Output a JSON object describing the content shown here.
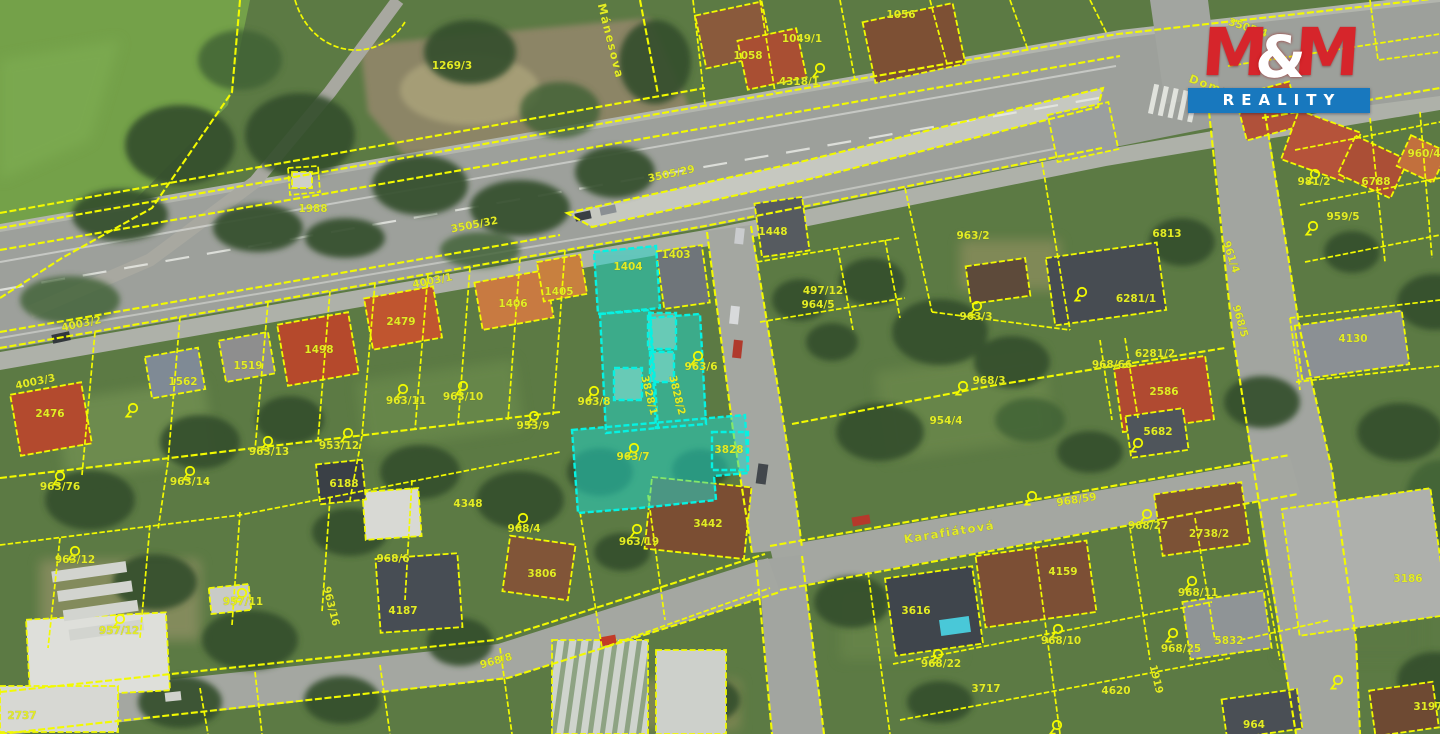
{
  "logo": {
    "m1": "M",
    "amp": "&",
    "m2": "M",
    "reality": "REALITY"
  },
  "colors": {
    "cadastral_line": "#f2fa00",
    "label": "#e3ec25",
    "highlight_fill": "#20d9cc",
    "highlight_stroke": "#06f2e2",
    "logo_red": "#d6252b",
    "logo_blue": "#1878be"
  },
  "map": {
    "street_labels": [
      {
        "t": "Domažlická",
        "x": 1230,
        "y": 97,
        "r": 20,
        "k": "street"
      },
      {
        "t": "Karafiátová",
        "x": 950,
        "y": 536,
        "r": -9,
        "k": "street"
      },
      {
        "t": "Mánesova",
        "x": 607,
        "y": 42,
        "r": 76,
        "k": "street"
      }
    ],
    "labels": [
      {
        "t": "3505/4",
        "x": 1247,
        "y": 31,
        "r": 18
      },
      {
        "t": "3505/29",
        "x": 672,
        "y": 177,
        "r": -12
      },
      {
        "t": "3505/32",
        "x": 475,
        "y": 228,
        "r": -11
      },
      {
        "t": "4003/1",
        "x": 433,
        "y": 284,
        "r": -11
      },
      {
        "t": "4003/2",
        "x": 82,
        "y": 327,
        "r": -12
      },
      {
        "t": "4003/3",
        "x": 36,
        "y": 385,
        "r": -12
      },
      {
        "t": "1269/3",
        "x": 452,
        "y": 69
      },
      {
        "t": "1988",
        "x": 313,
        "y": 212
      },
      {
        "t": "1058",
        "x": 748,
        "y": 59
      },
      {
        "t": "1049/1",
        "x": 802,
        "y": 42
      },
      {
        "t": "1056",
        "x": 901,
        "y": 18
      },
      {
        "t": "4318/1",
        "x": 799,
        "y": 85
      },
      {
        "t": "1403",
        "x": 676,
        "y": 258
      },
      {
        "t": "1404",
        "x": 628,
        "y": 270
      },
      {
        "t": "1448",
        "x": 773,
        "y": 235
      },
      {
        "t": "497/12",
        "x": 823,
        "y": 294
      },
      {
        "t": "964/5",
        "x": 818,
        "y": 308
      },
      {
        "t": "963/2",
        "x": 973,
        "y": 239
      },
      {
        "t": "6813",
        "x": 1167,
        "y": 237
      },
      {
        "t": "963/3",
        "x": 976,
        "y": 320
      },
      {
        "t": "968/3",
        "x": 989,
        "y": 384
      },
      {
        "t": "6281/1",
        "x": 1136,
        "y": 302
      },
      {
        "t": "6281/2",
        "x": 1155,
        "y": 357
      },
      {
        "t": "968/66",
        "x": 1112,
        "y": 368
      },
      {
        "t": "2586",
        "x": 1164,
        "y": 395
      },
      {
        "t": "5682",
        "x": 1158,
        "y": 435
      },
      {
        "t": "954/4",
        "x": 946,
        "y": 424
      },
      {
        "t": "1498",
        "x": 319,
        "y": 353
      },
      {
        "t": "2479",
        "x": 401,
        "y": 325
      },
      {
        "t": "2476",
        "x": 50,
        "y": 417
      },
      {
        "t": "1406",
        "x": 513,
        "y": 307
      },
      {
        "t": "1405",
        "x": 559,
        "y": 295
      },
      {
        "t": "1519",
        "x": 248,
        "y": 369
      },
      {
        "t": "1562",
        "x": 183,
        "y": 385
      },
      {
        "t": "963/8",
        "x": 594,
        "y": 405
      },
      {
        "t": "963/6",
        "x": 701,
        "y": 370
      },
      {
        "t": "963/7",
        "x": 633,
        "y": 460
      },
      {
        "t": "3828",
        "x": 729,
        "y": 453
      },
      {
        "t": "3828/1",
        "x": 646,
        "y": 396,
        "r": 76,
        "s": 9
      },
      {
        "t": "3828/2",
        "x": 674,
        "y": 396,
        "r": 76,
        "s": 9
      },
      {
        "t": "963/11",
        "x": 406,
        "y": 404
      },
      {
        "t": "963/10",
        "x": 463,
        "y": 400
      },
      {
        "t": "953/9",
        "x": 533,
        "y": 429
      },
      {
        "t": "953/12",
        "x": 339,
        "y": 449
      },
      {
        "t": "6188",
        "x": 344,
        "y": 487
      },
      {
        "t": "963/13",
        "x": 269,
        "y": 455
      },
      {
        "t": "963/76",
        "x": 60,
        "y": 490
      },
      {
        "t": "963/14",
        "x": 190,
        "y": 485
      },
      {
        "t": "963/12",
        "x": 75,
        "y": 563
      },
      {
        "t": "957/11",
        "x": 243,
        "y": 605
      },
      {
        "t": "957/12",
        "x": 119,
        "y": 634
      },
      {
        "t": "963/16",
        "x": 328,
        "y": 607,
        "r": 76,
        "s": 9
      },
      {
        "t": "2737",
        "x": 22,
        "y": 719
      },
      {
        "t": "968/6",
        "x": 393,
        "y": 562
      },
      {
        "t": "968/4",
        "x": 524,
        "y": 532
      },
      {
        "t": "4348",
        "x": 468,
        "y": 507
      },
      {
        "t": "3806",
        "x": 542,
        "y": 577
      },
      {
        "t": "4187",
        "x": 403,
        "y": 614
      },
      {
        "t": "968/8",
        "x": 497,
        "y": 664,
        "r": -16
      },
      {
        "t": "963/19",
        "x": 639,
        "y": 545
      },
      {
        "t": "3442",
        "x": 708,
        "y": 527
      },
      {
        "t": "4159",
        "x": 1063,
        "y": 575
      },
      {
        "t": "968/10",
        "x": 1061,
        "y": 644
      },
      {
        "t": "3616",
        "x": 916,
        "y": 614
      },
      {
        "t": "968/22",
        "x": 941,
        "y": 667
      },
      {
        "t": "4620",
        "x": 1116,
        "y": 694
      },
      {
        "t": "3717",
        "x": 986,
        "y": 692
      },
      {
        "t": "968/27",
        "x": 1148,
        "y": 529
      },
      {
        "t": "2738/2",
        "x": 1209,
        "y": 537
      },
      {
        "t": "968/11",
        "x": 1198,
        "y": 596
      },
      {
        "t": "968/25",
        "x": 1181,
        "y": 652
      },
      {
        "t": "5832",
        "x": 1229,
        "y": 644
      },
      {
        "t": "1919",
        "x": 1153,
        "y": 680,
        "r": 76,
        "s": 9
      },
      {
        "t": "3186",
        "x": 1408,
        "y": 582
      },
      {
        "t": "3197",
        "x": 1428,
        "y": 710
      },
      {
        "t": "964",
        "x": 1254,
        "y": 728
      },
      {
        "t": "968/59",
        "x": 1077,
        "y": 503,
        "r": -9
      },
      {
        "t": "968/5",
        "x": 1237,
        "y": 322,
        "r": 74,
        "s": 9
      },
      {
        "t": "961/4",
        "x": 1228,
        "y": 258,
        "r": 72
      },
      {
        "t": "959/5",
        "x": 1343,
        "y": 220
      },
      {
        "t": "981/2",
        "x": 1314,
        "y": 185
      },
      {
        "t": "6788",
        "x": 1376,
        "y": 185
      },
      {
        "t": "960/4",
        "x": 1424,
        "y": 157
      },
      {
        "t": "4130",
        "x": 1353,
        "y": 342
      }
    ],
    "markers": [
      [
        594,
        391
      ],
      [
        634,
        448
      ],
      [
        698,
        356
      ],
      [
        403,
        389
      ],
      [
        463,
        386
      ],
      [
        534,
        416
      ],
      [
        348,
        433
      ],
      [
        60,
        476
      ],
      [
        190,
        471
      ],
      [
        268,
        441
      ],
      [
        133,
        408
      ],
      [
        977,
        306
      ],
      [
        963,
        386
      ],
      [
        1082,
        292
      ],
      [
        1058,
        629
      ],
      [
        938,
        654
      ],
      [
        242,
        593
      ],
      [
        120,
        619
      ],
      [
        637,
        529
      ],
      [
        75,
        551
      ],
      [
        1147,
        514
      ],
      [
        1192,
        581
      ],
      [
        1173,
        633
      ],
      [
        1313,
        226
      ],
      [
        1315,
        174
      ],
      [
        523,
        518
      ],
      [
        1138,
        443
      ],
      [
        820,
        68
      ],
      [
        1032,
        496
      ],
      [
        1057,
        725
      ],
      [
        1338,
        680
      ]
    ]
  }
}
